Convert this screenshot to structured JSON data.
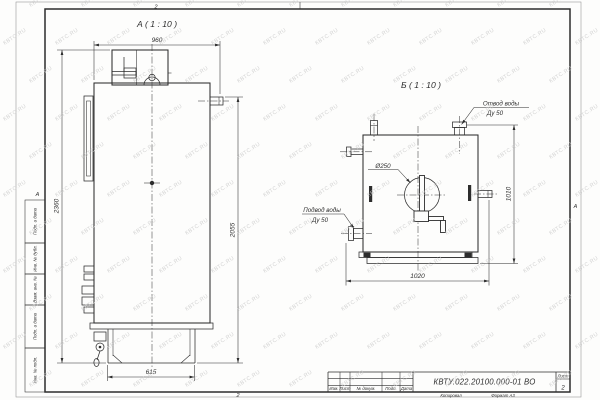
{
  "watermark": {
    "text": "КВТС.RU"
  },
  "frame": {
    "zone_top": "2",
    "zone_bottom": "2",
    "zone_left": "А",
    "zone_right": "А",
    "side_fields": [
      "Подп. и дата",
      "Инв. № дубл.",
      "Взам. инв. №",
      "Подп. и дата",
      "Инв. № подл."
    ]
  },
  "view_a": {
    "label": "А ( 1 : 10 )",
    "dims": {
      "top": "960",
      "left": "2360",
      "right": "2055",
      "base": "615"
    }
  },
  "view_b": {
    "label": "Б ( 1 : 10 )",
    "door_diameter": "Ø250",
    "outlet": {
      "line1": "Отвод воды",
      "line2": "Ду 50"
    },
    "inlet": {
      "line1": "Подвод воды",
      "line2": "Ду 50"
    },
    "dims": {
      "bottom": "1020",
      "right": "1010"
    }
  },
  "title_block": {
    "doc_number": "КВТУ.022.20100.000-01 ВО",
    "columns": {
      "izm": "Изм.",
      "list": "Лист",
      "docnum": "№ докум.",
      "podp": "Подп.",
      "data": "Дата"
    },
    "sheet": {
      "label": "Лист",
      "value": "2"
    },
    "footer": {
      "copied": "Копировал",
      "format": "Формат А3"
    }
  }
}
